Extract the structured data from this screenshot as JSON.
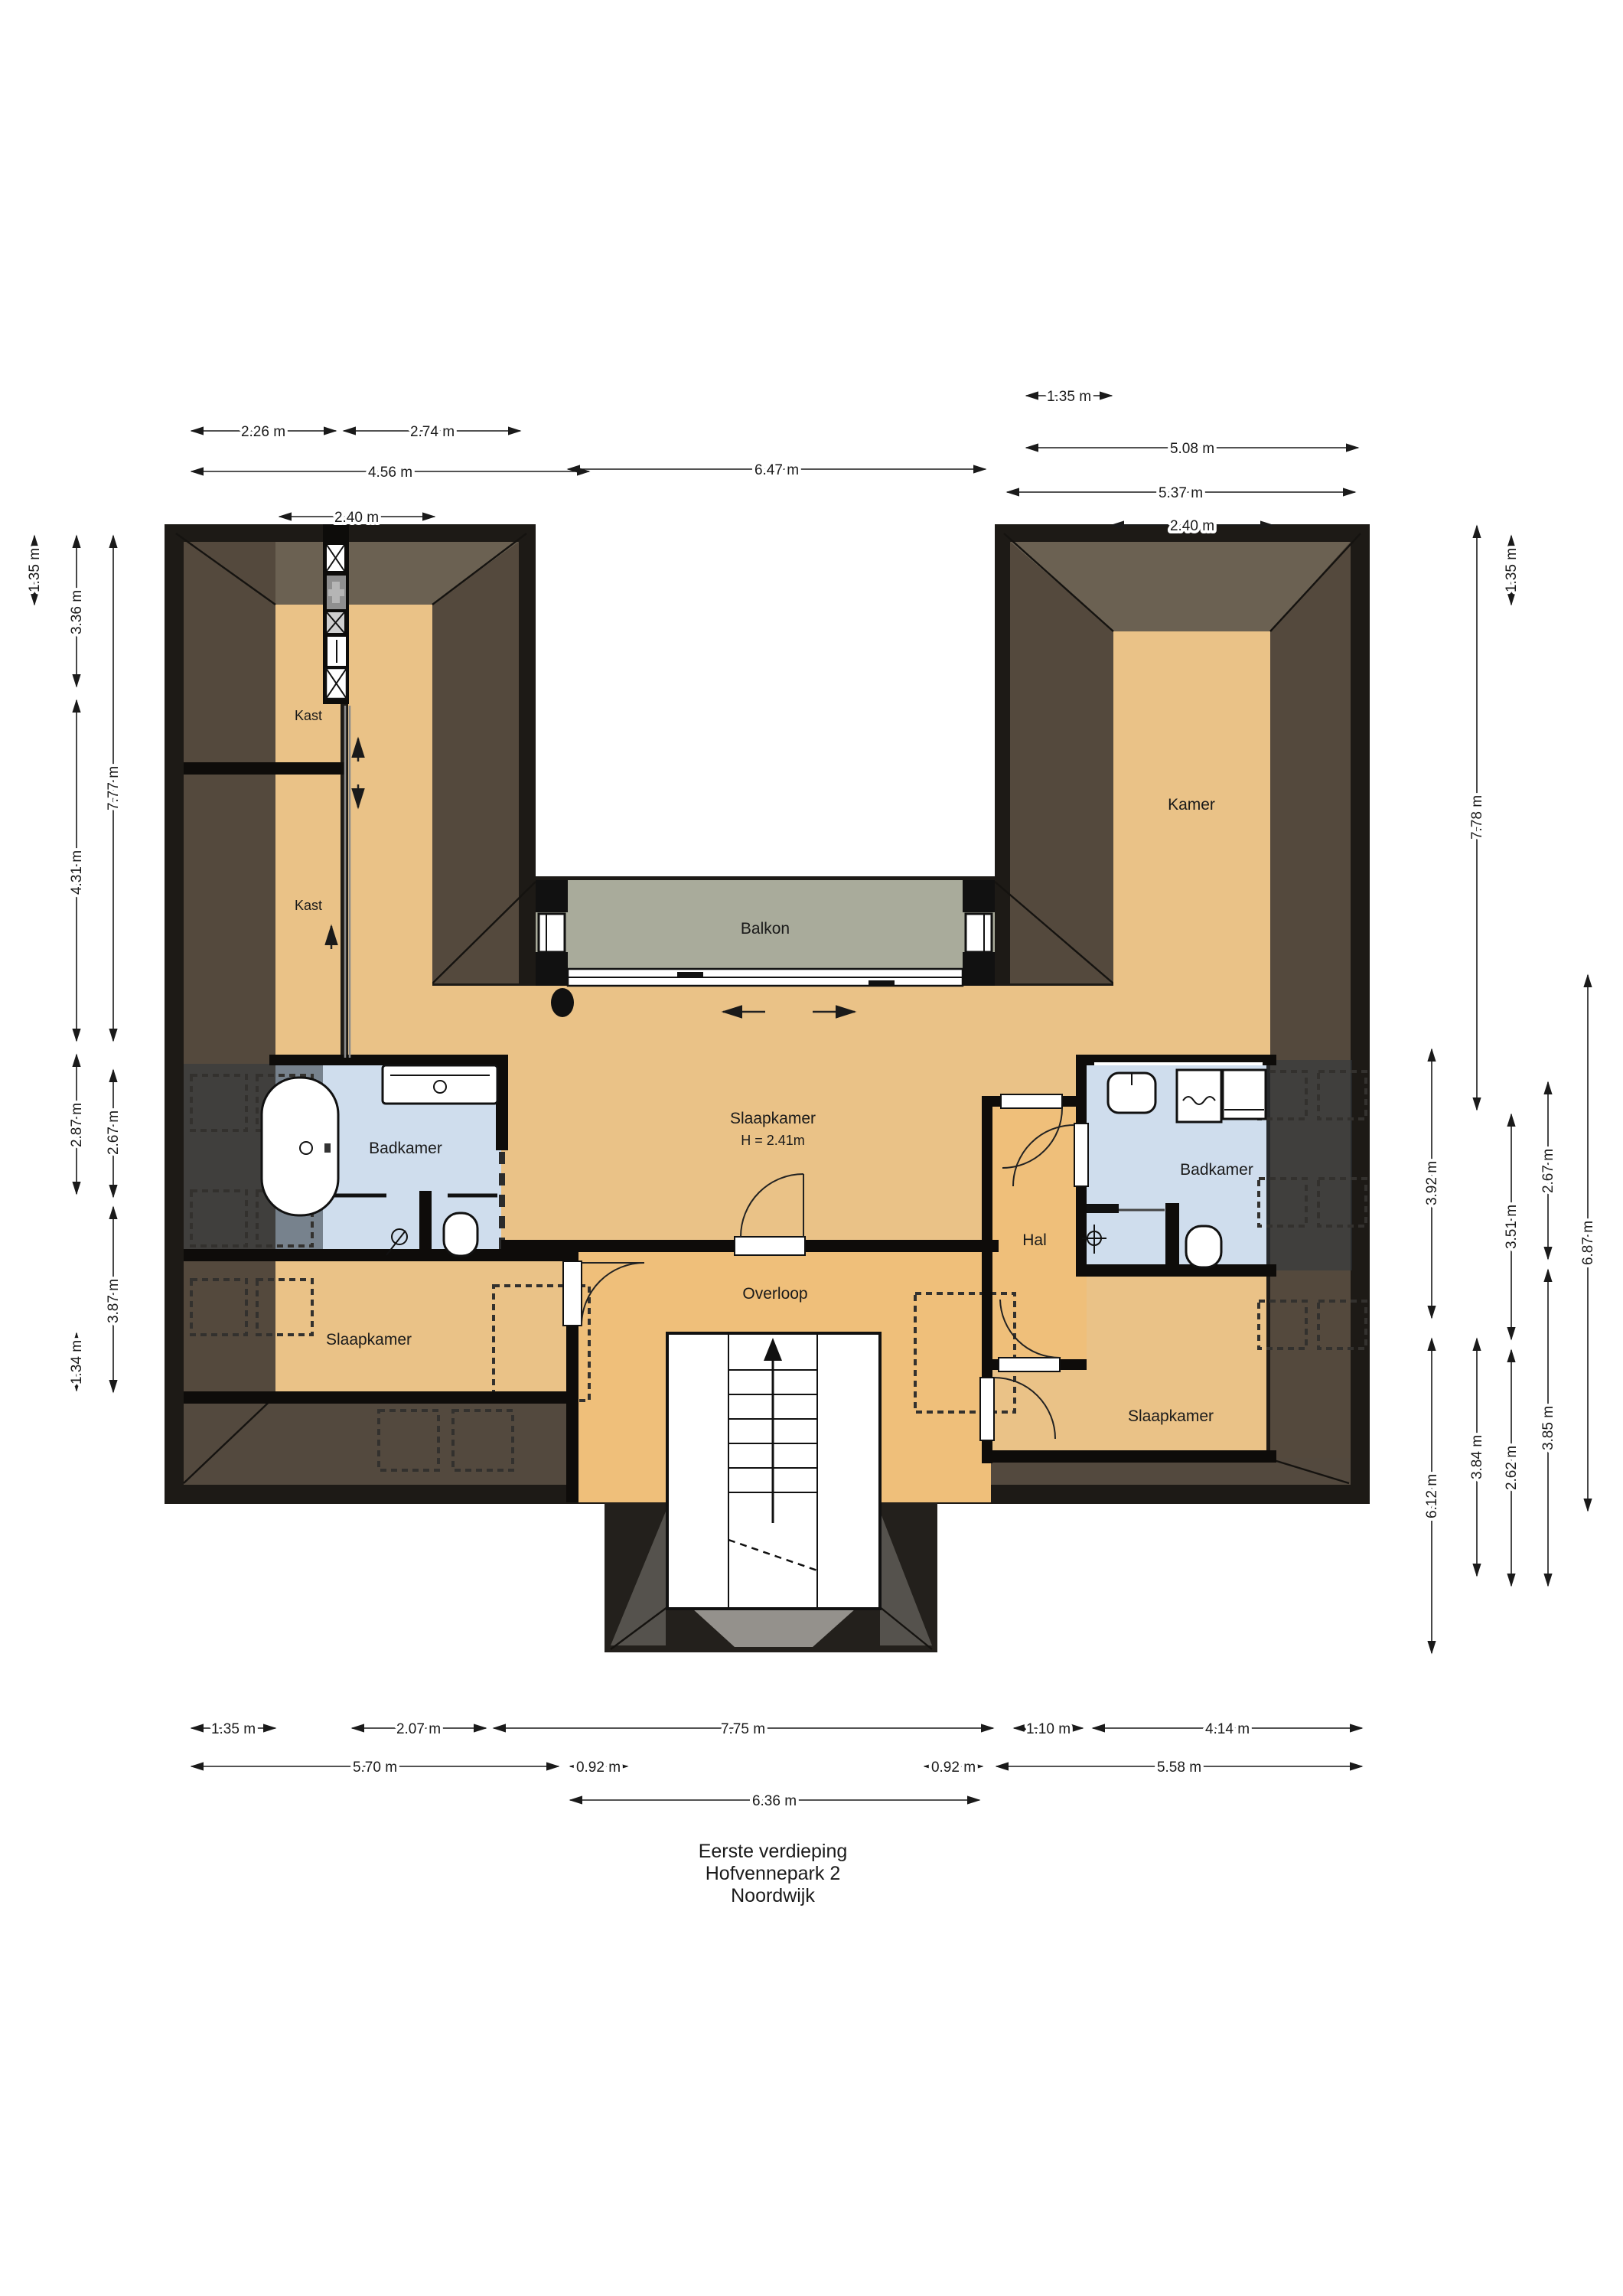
{
  "title_block": {
    "line1": "Eerste verdieping",
    "line2": "Hofvennepark 2",
    "line3": "Noordwijk"
  },
  "rooms": {
    "kast_top": "Kast",
    "kast_bottom": "Kast",
    "kamer": "Kamer",
    "balkon": "Balkon",
    "slaapkamer_center": "Slaapkamer",
    "slaapkamer_center_height": "H = 2.41m",
    "badkamer_left": "Badkamer",
    "badkamer_right": "Badkamer",
    "hal": "Hal",
    "overloop": "Overloop",
    "slaapkamer_left": "Slaapkamer",
    "slaapkamer_right": "Slaapkamer"
  },
  "dimensions": {
    "top": [
      {
        "label": "1.35 m"
      },
      {
        "label": "2.26 m"
      },
      {
        "label": "2.74 m"
      },
      {
        "label": "5.08 m"
      },
      {
        "label": "4.56 m"
      },
      {
        "label": "6.47 m"
      },
      {
        "label": "5.37 m"
      },
      {
        "label": "2.40 m"
      },
      {
        "label": "2.40 m"
      }
    ],
    "bottom": [
      {
        "label": "1.35 m"
      },
      {
        "label": "2.07 m"
      },
      {
        "label": "7.75 m"
      },
      {
        "label": "1.10 m"
      },
      {
        "label": "4.14 m"
      },
      {
        "label": "5.70 m"
      },
      {
        "label": "0.92 m"
      },
      {
        "label": "0.92 m"
      },
      {
        "label": "5.58 m"
      },
      {
        "label": "6.36 m"
      }
    ],
    "left": [
      {
        "label": "1.35 m"
      },
      {
        "label": "3.36 m"
      },
      {
        "label": "7.77 m"
      },
      {
        "label": "4.31 m"
      },
      {
        "label": "2.87 m"
      },
      {
        "label": "2.67 m"
      },
      {
        "label": "3.87 m"
      },
      {
        "label": "1.34 m"
      }
    ],
    "right": [
      {
        "label": "1.35 m"
      },
      {
        "label": "7.78 m"
      },
      {
        "label": "3.92 m"
      },
      {
        "label": "2.67 m"
      },
      {
        "label": "6.87 m"
      },
      {
        "label": "3.51 m"
      },
      {
        "label": "3.84 m"
      },
      {
        "label": "3.85 m"
      },
      {
        "label": "2.62 m"
      },
      {
        "label": "6.12 m"
      }
    ]
  },
  "palette": {
    "roof_dark": "#1d1a16",
    "roof_side": "#54493d",
    "roof_top": "#6b6152",
    "floor_tan": "#eac287",
    "floor_orange": "#efbf7a",
    "balcony": "#a9ab9b",
    "bathroom": "#cfdded",
    "low_headroom_overlay": "rgba(48,54,62,0.55)"
  }
}
